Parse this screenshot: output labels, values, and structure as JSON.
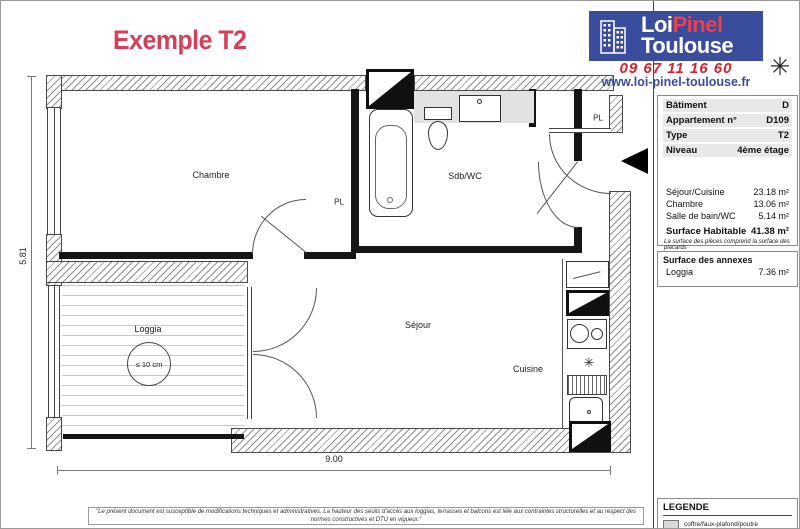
{
  "plan": {
    "title": "Exemple T2",
    "labels": {
      "chambre": "Chambre",
      "pl_chambre": "PL",
      "sdb_wc": "Sdb/WC",
      "pl_entree": "PL",
      "sejour": "Séjour",
      "cuisine": "Cuisine",
      "loggia": "Loggia",
      "seuil": "≤ 10 cm"
    },
    "dimensions": {
      "width": "9.00",
      "height": "5.81"
    }
  },
  "branding": {
    "brand_line1_a": "Loi",
    "brand_line1_b": "Pinel",
    "brand_line2": "Toulouse",
    "phone": "09 67 11 16 60",
    "website": "www.loi-pinel-toulouse.fr",
    "colors": {
      "logo_blue": "#3a4c9c",
      "brand_red": "#e8414f",
      "phone_red": "#d6232f",
      "title_red": "#d4405a"
    }
  },
  "apartment_info": {
    "rows": [
      {
        "label": "Bâtiment",
        "value": "D"
      },
      {
        "label": "Appartement n°",
        "value": "D109"
      },
      {
        "label": "Type",
        "value": "T2"
      },
      {
        "label": "Niveau",
        "value": "4ème étage"
      }
    ],
    "surfaces": [
      {
        "label": "Séjour/Cuisine",
        "value": "23.18 m²"
      },
      {
        "label": "Chambre",
        "value": "13.06 m²"
      },
      {
        "label": "Salle de bain/WC",
        "value": "5.14 m²"
      }
    ],
    "total": {
      "label": "Surface Habitable",
      "value": "41.38 m²"
    },
    "note": "La surface des pièces comprend la surface des placards"
  },
  "annexes": {
    "title": "Surface des annexes",
    "rows": [
      {
        "label": "Loggia",
        "value": "7.36 m²"
      }
    ]
  },
  "legend": {
    "title": "LEGENDE",
    "items": [
      {
        "label": "coffre/faux-plafond/poutre"
      }
    ]
  },
  "disclaimer": "\"Le présent document est susceptible de modifications techniques et administratives. La hauteur des seuils d'accès aux loggias, terrasses et balcons est liée aux contraintes structurelles et au respect des normes constructives et DTU en vigueur.\""
}
